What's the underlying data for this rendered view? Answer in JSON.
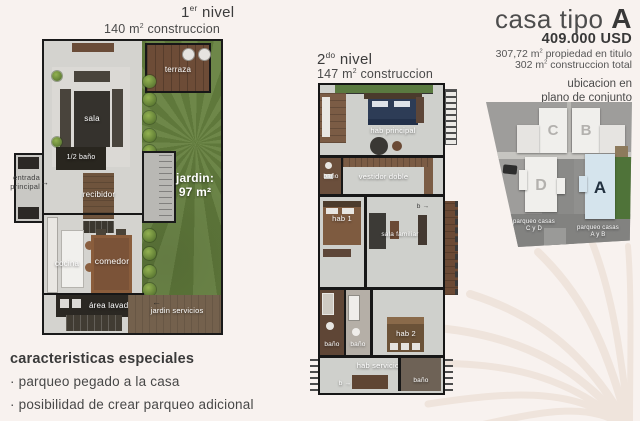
{
  "palette": {
    "background": "#f8f2ef",
    "walls": "#171717",
    "floor_gray": "#d4d3cf",
    "garden_green": "#66813f",
    "terrace_wood": "#6d4c37",
    "site_gray": "#9e9d9b",
    "house_white": "#f0efec",
    "house_a_fill": "#d5e4ed",
    "house_a_letter": "#22303f",
    "headline_text": "#3f3f3f"
  },
  "header": {
    "title_regular": "casa tipo",
    "title_bold": "A",
    "price": "409.000 USD",
    "spec1_pre": "307,72 m",
    "spec1_sup": "2",
    "spec1_post": " propiedad en titulo",
    "spec2_pre": "302 m",
    "spec2_sup": "2",
    "spec2_post": " construccion total"
  },
  "location": {
    "caption_line1": "ubicacion en",
    "caption_line2": "plano de conjunto",
    "house_a": "A",
    "house_b": "B",
    "house_c": "C",
    "house_d": "D",
    "parking_cd_line1": "parqueo casas",
    "parking_cd_line2": "C y D",
    "parking_ab_line1": "parqueo casas",
    "parking_ab_line2": "A y B"
  },
  "level1": {
    "title_num": "1",
    "title_ord": "er",
    "title_word": " nivel",
    "area_pre": "140 m",
    "area_sup": "2",
    "area_post": " construccion",
    "rooms": {
      "terraza": "terraza",
      "sala": "sala",
      "half_bath": "1/2 baño",
      "entrada_line1": "entrada",
      "entrada_line2": "principal",
      "entrada_arrow": "→",
      "recibidor": "recibidor",
      "jardin_line1": "jardin:",
      "jardin_line2": "97 m²",
      "cocina": "cocina",
      "comedor": "comedor",
      "area_lavado": "área lavado",
      "jardin_servicios": "jardin servicios",
      "servicio_arrow": "←"
    }
  },
  "level2": {
    "title_num": "2",
    "title_ord": "do",
    "title_word": " nivel",
    "area_pre": "147 m",
    "area_sup": "2",
    "area_post": " construccion",
    "rooms": {
      "hab_principal": "hab principal",
      "bano_top": "baño",
      "vestidor": "vestidor doble",
      "hab_1": "hab 1",
      "sala_familiar": "sala familiar",
      "arrow_b_mid": "b →",
      "bano_left": "baño",
      "bano_mid": "baño",
      "hab_2": "hab 2",
      "hab_servicio": "hab servicio",
      "arrow_b_bottom": "b →",
      "bano_servicio": "baño"
    }
  },
  "features": {
    "title": "caracteristicas especiales",
    "items": [
      "· parqueo pegado a la casa",
      "· posibilidad de crear parqueo adicional"
    ]
  }
}
